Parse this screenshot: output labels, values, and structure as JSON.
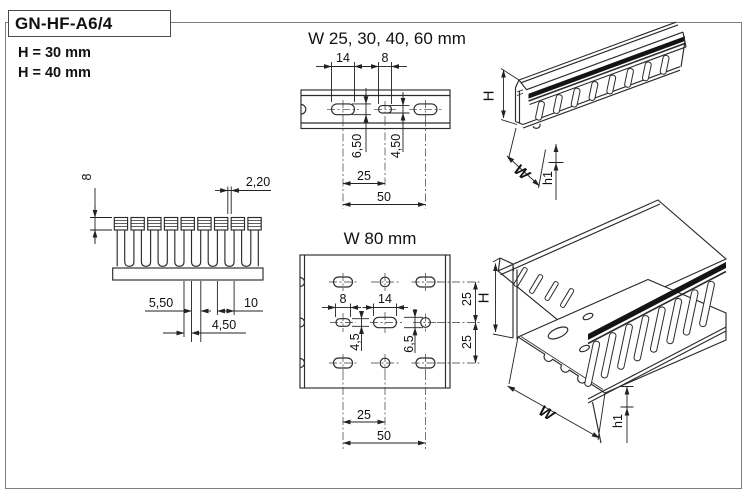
{
  "header": {
    "product_code": "GN-HF-A6/4",
    "variant_30": "H = 30 mm",
    "variant_40": "H = 40 mm"
  },
  "strip": {
    "title": "W 25, 30, 40, 60 mm",
    "dim_slot_length": "14",
    "dim_small_slot_length": "8",
    "dim_slot_height": "6,50",
    "dim_small_slot_height": "4,50",
    "dim_spacing": "25",
    "dim_pitch": "50"
  },
  "comb": {
    "dim_rib_height": "8",
    "dim_slot_top_width": "2,20",
    "dim_slot_width": "5,50",
    "dim_finger_width": "4,50",
    "dim_pitch": "10"
  },
  "plate": {
    "title": "W 80 mm",
    "dim_small_slot": "8",
    "dim_large_slot": "14",
    "dim_small_slot_height": "4,5",
    "dim_large_slot_height": "6,5",
    "dim_row_upper": "25",
    "dim_row_lower": "25",
    "dim_col_spacing": "25",
    "dim_col_pitch": "50"
  },
  "iso_closed": {
    "height": "H",
    "width": "W",
    "foot": "h1"
  },
  "iso_open": {
    "height": "H",
    "width": "W",
    "foot": "h1"
  },
  "colors": {
    "line": "#2b2b2b",
    "stripe": "#141414",
    "frame": "#7d7d7d"
  }
}
